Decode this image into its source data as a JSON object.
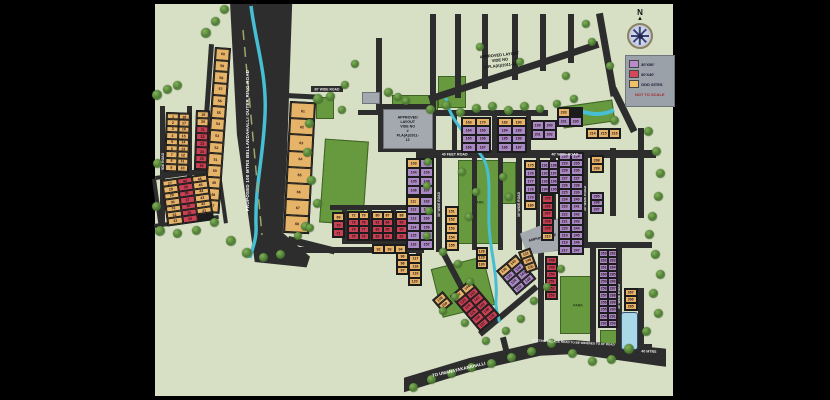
{
  "legend": {
    "items": [
      {
        "label": "30'X50'",
        "color": "#b78cc8"
      },
      {
        "label": "30'X40'",
        "color": "#d4475a"
      },
      {
        "label": "ODD SITES",
        "color": "#eec169"
      }
    ],
    "note": "NOT TO SCALE"
  },
  "compass": {
    "label": "N"
  },
  "annotations": {
    "approved_top": "APPROVED LAYOUT VIDE NO\n# PLA(A)/2011-12",
    "approved_box": "APPROVED LAYOUT VIDE NO\n# PLA(A)/2011-12",
    "amphitheatre": "AMPHITHEATRE",
    "park": "PARK"
  },
  "roads": {
    "ring": "PROPOSED 100 MTRS BELLANDAHALLI OUTER RING ROAD",
    "thirty": "30' WIDE ROAD",
    "forty_feet": "40 FEET ROAD",
    "forty_wide": "40' WIDE ROAD",
    "to_village": "TO UMANAYAKANAHALLI",
    "existing": "EXISTING VILLAGE ROAD TO BE WIDENED TO 40' ROAD",
    "mtrs": "40 MTRS"
  },
  "colors": {
    "map_bg": "#d7dfc5",
    "road": "#2d2d2d",
    "plot_orange": "#e6b469",
    "plot_red": "#c84054",
    "plot_purple": "#a989c4",
    "park_green": "#67993f",
    "water": "#46bfd3",
    "legend_bg": "#9aa1a9"
  },
  "clusters": [
    {
      "id": "a1",
      "c": "o",
      "rows": [
        [
          "1",
          "18"
        ],
        [
          "2",
          "17"
        ],
        [
          "3",
          "16"
        ],
        [
          "4",
          "15"
        ],
        [
          "5",
          "14"
        ],
        [
          "6",
          "13"
        ],
        [
          "7",
          "12"
        ],
        [
          "8",
          "11"
        ],
        [
          "9",
          "10"
        ]
      ]
    },
    {
      "id": "b",
      "c": "o",
      "rows": [
        [
          "19"
        ],
        [
          "20"
        ],
        [
          "21:r"
        ],
        [
          "22:r"
        ],
        [
          "23:r"
        ],
        [
          "24:r"
        ],
        [
          "25:r"
        ],
        [
          "26:r"
        ]
      ]
    },
    {
      "id": "w47",
      "c": "o",
      "rows": [
        [
          "60"
        ],
        [
          "59"
        ],
        [
          "58"
        ],
        [
          "57"
        ],
        [
          "56"
        ],
        [
          "55"
        ],
        [
          "54"
        ],
        [
          "53"
        ],
        [
          "52"
        ],
        [
          "51"
        ],
        [
          "50"
        ],
        [
          "49"
        ],
        [
          "48"
        ],
        [
          "47"
        ]
      ]
    },
    {
      "id": "cl",
      "c": "o",
      "rows": [
        [
          "27",
          "40:r",
          "46"
        ],
        [
          "28",
          "39:r",
          "45"
        ],
        [
          "29",
          "38:r",
          "44"
        ],
        [
          "30",
          "37:r",
          "43"
        ],
        [
          "31",
          "36:r",
          "42"
        ],
        [
          "32",
          "35:r",
          "41"
        ],
        [
          "33",
          "34:r"
        ]
      ]
    },
    {
      "id": "c61",
      "c": "o",
      "rows": [
        [
          "61"
        ],
        [
          "62"
        ],
        [
          "63"
        ],
        [
          "64"
        ],
        [
          "65"
        ],
        [
          "66"
        ],
        [
          "67"
        ],
        [
          "68"
        ]
      ]
    },
    {
      "id": "c69",
      "c": "o",
      "rows": [
        [
          "69"
        ],
        [
          "70:r"
        ],
        [
          "71:r"
        ]
      ]
    },
    {
      "id": "c72",
      "c": "r",
      "rows": [
        [
          "72:o",
          "79:o"
        ],
        [
          "73",
          "78"
        ],
        [
          "74",
          "77"
        ],
        [
          "75",
          "76"
        ]
      ]
    },
    {
      "id": "c80",
      "c": "r",
      "rows": [
        [
          "80:o",
          "87:o"
        ],
        [
          "81",
          "86"
        ],
        [
          "82",
          "85"
        ],
        [
          "83",
          "84"
        ]
      ]
    },
    {
      "id": "c88",
      "c": "r",
      "rows": [
        [
          "88:o",
          "99:o"
        ],
        [
          "89",
          "100"
        ],
        [
          "90",
          "101"
        ],
        [
          "91",
          "102"
        ]
      ]
    },
    {
      "id": "c92",
      "c": "o",
      "rows": [
        [
          "92",
          "93",
          "94"
        ]
      ]
    },
    {
      "id": "c96",
      "c": "o",
      "rows": [
        [
          "96"
        ],
        [
          "98"
        ],
        [
          "97"
        ]
      ]
    },
    {
      "id": "m1",
      "c": "p",
      "rows": [
        [
          "103:o",
          "110"
        ],
        [
          "104",
          "109"
        ],
        [
          "105",
          "108"
        ],
        [
          "106",
          "107"
        ]
      ]
    },
    {
      "id": "m2",
      "c": "p",
      "rows": [
        [
          "111:o",
          "162"
        ],
        [
          "112",
          "161"
        ],
        [
          "113",
          "160"
        ],
        [
          "114",
          "159"
        ],
        [
          "115",
          "158"
        ],
        [
          "116",
          "157"
        ]
      ]
    },
    {
      "id": "m3",
      "c": "o",
      "rows": [
        [
          "117"
        ],
        [
          "118"
        ],
        [
          "119"
        ],
        [
          "120"
        ]
      ]
    },
    {
      "id": "m4",
      "c": "o",
      "rows": [
        [
          "151"
        ],
        [
          "152"
        ],
        [
          "153"
        ],
        [
          "154"
        ],
        [
          "155"
        ]
      ]
    },
    {
      "id": "n1",
      "c": "p",
      "rows": [
        [
          "163:o",
          "170:o"
        ],
        [
          "164",
          "169"
        ],
        [
          "165",
          "168"
        ],
        [
          "166",
          "167"
        ]
      ]
    },
    {
      "id": "n2",
      "c": "p",
      "rows": [
        [
          "183:o",
          "190:o"
        ],
        [
          "184",
          "189"
        ],
        [
          "185",
          "188"
        ],
        [
          "186",
          "187"
        ]
      ]
    },
    {
      "id": "n3",
      "c": "p",
      "rows": [
        [
          "199",
          "200"
        ],
        [
          "201",
          "202"
        ]
      ]
    },
    {
      "id": "n4",
      "c": "p",
      "rows": [
        [
          "233:o"
        ],
        [
          "231",
          "230"
        ]
      ]
    },
    {
      "id": "n5",
      "c": "o",
      "rows": [
        [
          "214",
          "215",
          "216"
        ]
      ]
    },
    {
      "id": "q1",
      "c": "p",
      "rows": [
        [
          "175:o"
        ],
        [
          "176"
        ],
        [
          "177"
        ],
        [
          "178"
        ],
        [
          "179"
        ],
        [
          "180:o"
        ]
      ]
    },
    {
      "id": "q2",
      "c": "p",
      "rows": [
        [
          "191",
          "198"
        ],
        [
          "192",
          "197"
        ],
        [
          "193",
          "196"
        ],
        [
          "194",
          "195"
        ]
      ]
    },
    {
      "id": "q3",
      "c": "r",
      "rows": [
        [
          "205"
        ],
        [
          "206"
        ],
        [
          "207"
        ],
        [
          "208"
        ],
        [
          "209"
        ],
        [
          "210:o"
        ]
      ]
    },
    {
      "id": "r1",
      "c": "p",
      "rows": [
        [
          "230",
          "234"
        ],
        [
          "229",
          "235"
        ],
        [
          "228",
          "236"
        ],
        [
          "227",
          "237"
        ],
        [
          "226",
          "238"
        ],
        [
          "225",
          "239"
        ],
        [
          "224",
          "240"
        ],
        [
          "223",
          "241"
        ],
        [
          "222",
          "242"
        ],
        [
          "221",
          "243"
        ],
        [
          "220",
          "244"
        ],
        [
          "219",
          "245"
        ],
        [
          "218",
          "246"
        ],
        [
          "217",
          "247"
        ]
      ]
    },
    {
      "id": "s1",
      "c": "o",
      "rows": [
        [
          "298"
        ],
        [
          "299"
        ]
      ]
    },
    {
      "id": "s2",
      "c": "p",
      "rows": [
        [
          "295"
        ],
        [
          "296"
        ],
        [
          "297"
        ]
      ]
    },
    {
      "id": "t1",
      "c": "p",
      "rows": [
        [
          "263",
          "282"
        ],
        [
          "262",
          "283"
        ],
        [
          "261",
          "284"
        ],
        [
          "260",
          "285"
        ],
        [
          "259",
          "286"
        ],
        [
          "258",
          "287"
        ],
        [
          "257",
          "288"
        ],
        [
          "256",
          "289"
        ],
        [
          "255",
          "290"
        ],
        [
          "254",
          "291"
        ],
        [
          "292",
          "293"
        ]
      ]
    },
    {
      "id": "u1",
      "c": "r",
      "rows": [
        [
          "248"
        ],
        [
          "249"
        ],
        [
          "250"
        ],
        [
          "251"
        ],
        [
          "252"
        ],
        [
          "253"
        ]
      ]
    },
    {
      "id": "v1",
      "c": "o",
      "rows": [
        [
          "267"
        ],
        [
          "266"
        ],
        [
          "265"
        ]
      ]
    },
    {
      "id": "d1",
      "c": "r",
      "rows": [
        [
          "122:o",
          "144:o"
        ],
        [
          "123",
          "143"
        ],
        [
          "124",
          "142"
        ],
        [
          "125",
          "141"
        ],
        [
          "126",
          "140"
        ],
        [
          "127",
          "139"
        ]
      ]
    },
    {
      "id": "d2",
      "c": "p",
      "rows": [
        [
          "136:o",
          "145:o"
        ],
        [
          "135",
          "146"
        ],
        [
          "134",
          "147"
        ],
        [
          "133",
          "148"
        ]
      ]
    },
    {
      "id": "d3",
      "c": "o",
      "rows": [
        [
          "128"
        ],
        [
          "129"
        ],
        [
          "130"
        ]
      ]
    },
    {
      "id": "d4",
      "c": "o",
      "rows": [
        [
          "131"
        ],
        [
          "149"
        ],
        [
          "150"
        ]
      ]
    },
    {
      "id": "d5",
      "c": "o",
      "rows": [
        [
          "158"
        ],
        [
          "159"
        ]
      ]
    }
  ]
}
